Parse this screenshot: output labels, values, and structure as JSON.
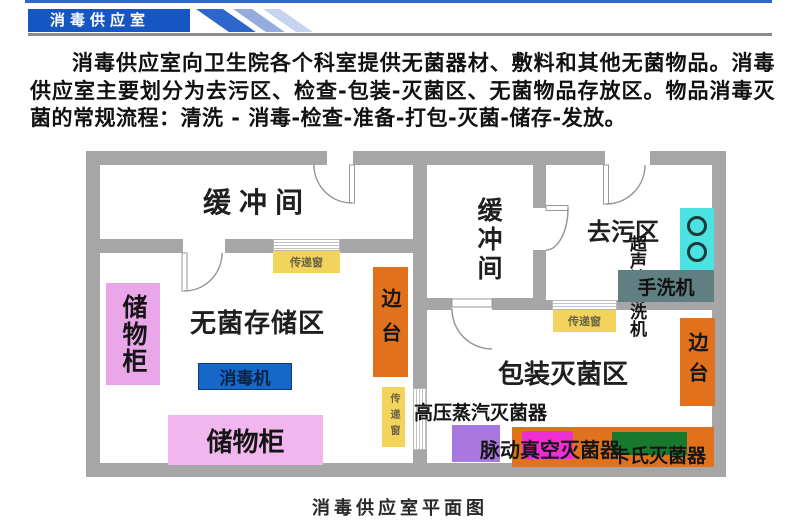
{
  "header": {
    "title": "消毒供应室"
  },
  "intro_text": "消毒供应室向卫生院各个科室提供无菌器材、敷料和其他无菌物品。消毒供应室主要划分为去污区、检查-包装-灭菌区、无菌物品存放区。物品消毒灭菌的常规流程：清洗 - 消毒-检查-准备-打包-灭菌-储存-发放。",
  "floorplan": {
    "caption": "消毒供应室平面图",
    "rooms": {
      "buffer_left": "缓冲间",
      "buffer_right": "缓冲间",
      "sterile_storage": "无菌存储区",
      "decontamination": "去污区",
      "packing_sterilization": "包装灭菌区"
    },
    "fixtures": {
      "storage_cabinet_left": "储物柜",
      "storage_cabinet_bottom": "储物柜",
      "disinfector": "消毒机",
      "side_table_left": "边台",
      "side_table_right": "边台",
      "transfer_window_left": "传递窗",
      "transfer_window_center": "传递窗",
      "transfer_window_right": "传递窗",
      "ultrasonic_cleaner": "超声波清洗机",
      "hand_washer": "手洗机",
      "steam_sterilizer": "高压蒸汽灭菌器",
      "pulse_vacuum_sterilizer": "脉动真空灭菌器",
      "cassette_sterilizer": "卡氏灭菌器"
    },
    "colors": {
      "wall": "#a6a6a6",
      "transfer_window_yellow": "#f2d45c",
      "side_table_orange": "#e2711d",
      "cabinet_pink": "#e9a6e9",
      "cabinet_pink_light": "#f2b6ee",
      "disinfector_blue": "#1668c8",
      "ultrasonic_cyan": "#4ce2e2",
      "hand_washer_slate": "#5f7f83",
      "steam_sterilizer_purple": "#a877e0",
      "pulse_vacuum_magenta": "#ee2ed0",
      "cassette_green": "#17782e",
      "header_blue": "#1556c2"
    }
  }
}
